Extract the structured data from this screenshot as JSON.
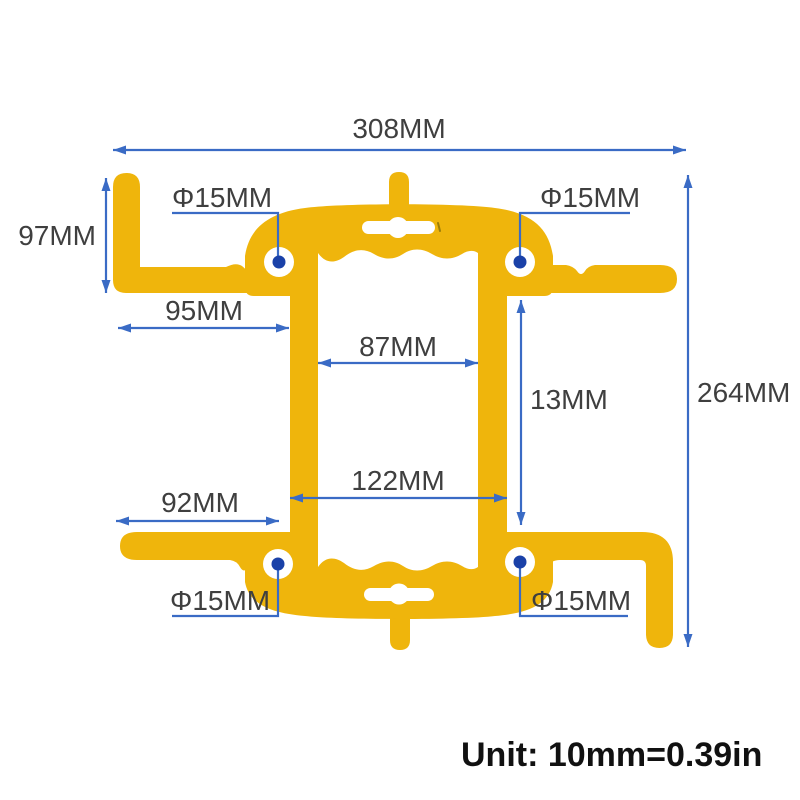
{
  "colors": {
    "background": "#FFFFFF",
    "bracket_yellow": "#EFB50C",
    "cutout_white": "#FFFFFF",
    "dim_blue": "#3A6BC5",
    "dot_navy": "#1A41A8",
    "label_gray": "#3F3F3F",
    "unit_black": "#111111",
    "mark_olive": "#9C7D08"
  },
  "labels": {
    "total_width": "308MM",
    "total_height": "264MM",
    "left_arm_height": "97MM",
    "upper_left_span": "95MM",
    "inner_opening_width": "87MM",
    "right_side_span": "13MM",
    "frame_outer_width": "122MM",
    "lower_left_span": "92MM",
    "hole_top_left": "Φ15MM",
    "hole_top_right": "Φ15MM",
    "hole_bottom_left": "Φ15MM",
    "hole_bottom_right": "Φ15MM"
  },
  "footer": {
    "unit_note": "Unit: 10mm=0.39in"
  }
}
